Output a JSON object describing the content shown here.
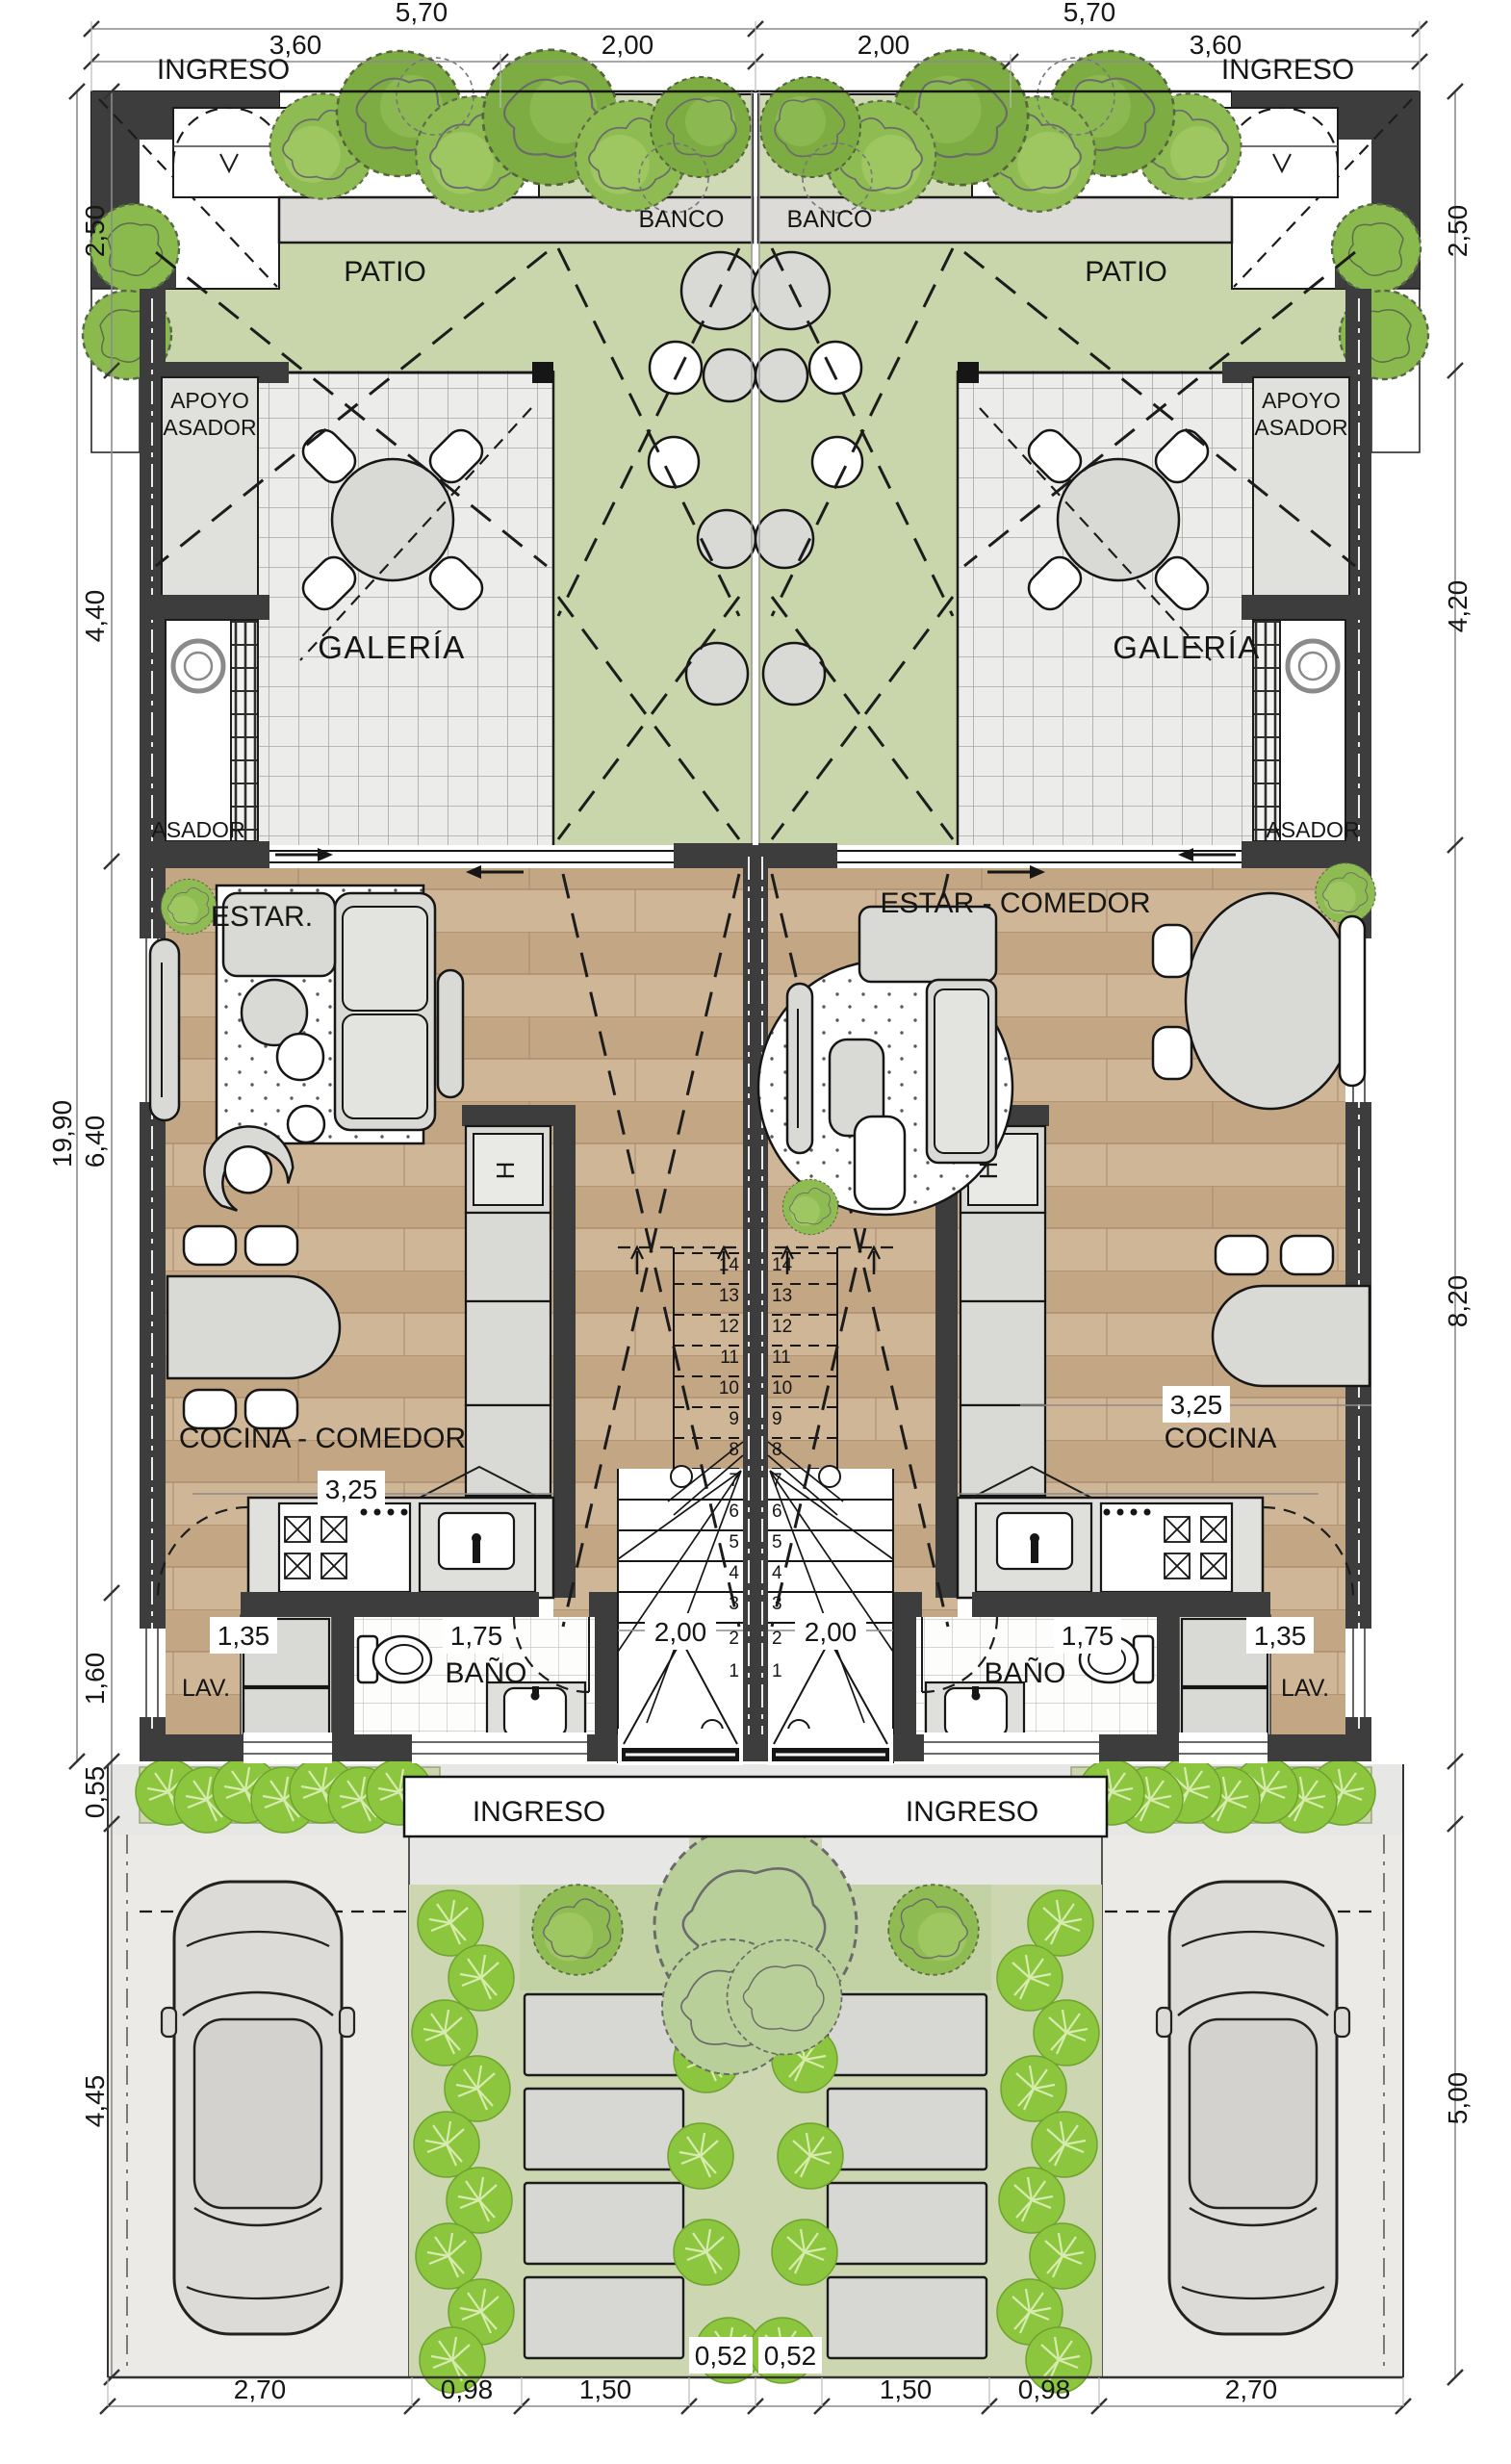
{
  "rooms": {
    "ingreso": "INGRESO",
    "patio": "PATIO",
    "banco": "BANCO",
    "apoyo_asador_line1": "APOYO",
    "apoyo_asador_line2": "ASADOR",
    "galeria": "GALERÍA",
    "asador": "ASADOR",
    "estar": "ESTAR.",
    "estar_comedor": "ESTAR - COMEDOR",
    "cocina_comedor": "COCINA - COMEDOR",
    "cocina": "COCINA",
    "banio": "BAÑO",
    "lav": "LAV."
  },
  "appliances": {
    "fridge": "H"
  },
  "dimensions": {
    "top_total_left": "5,70",
    "top_total_right": "5,70",
    "top_sub": [
      "3,60",
      "2,00",
      "2,00",
      "3,60"
    ],
    "left_side": {
      "patio": "2,50",
      "galeria": "4,40",
      "total": "19,90",
      "living": "6,40",
      "service": "1,60",
      "hedge": "0,55",
      "yard": "4,45"
    },
    "right_side": {
      "patio": "2,50",
      "galeria": "4,20",
      "living": "8,20",
      "yard": "5,00"
    },
    "bottom": [
      "2,70",
      "0,98",
      "1,50",
      "0,52",
      "0,52",
      "1,50",
      "0,98",
      "2,70"
    ],
    "kitchen": "3,25",
    "lav_width": "1,35",
    "bath_width": "1,75",
    "stair_width": "2,00"
  },
  "stairs": {
    "steps": [
      "1",
      "2",
      "3",
      "4",
      "5",
      "6",
      "7",
      "8",
      "9",
      "10",
      "11",
      "12",
      "13",
      "14"
    ]
  },
  "colors": {
    "patio_green": "#c9d6ab",
    "grass_green": "#ccd7b2",
    "shrub_green": "#8cc63f",
    "wood_floor": "#c8ae8f",
    "tile_gray": "#ececea",
    "wall_dark": "#3d3d3d",
    "furniture_gray": "#d9d9d6"
  }
}
